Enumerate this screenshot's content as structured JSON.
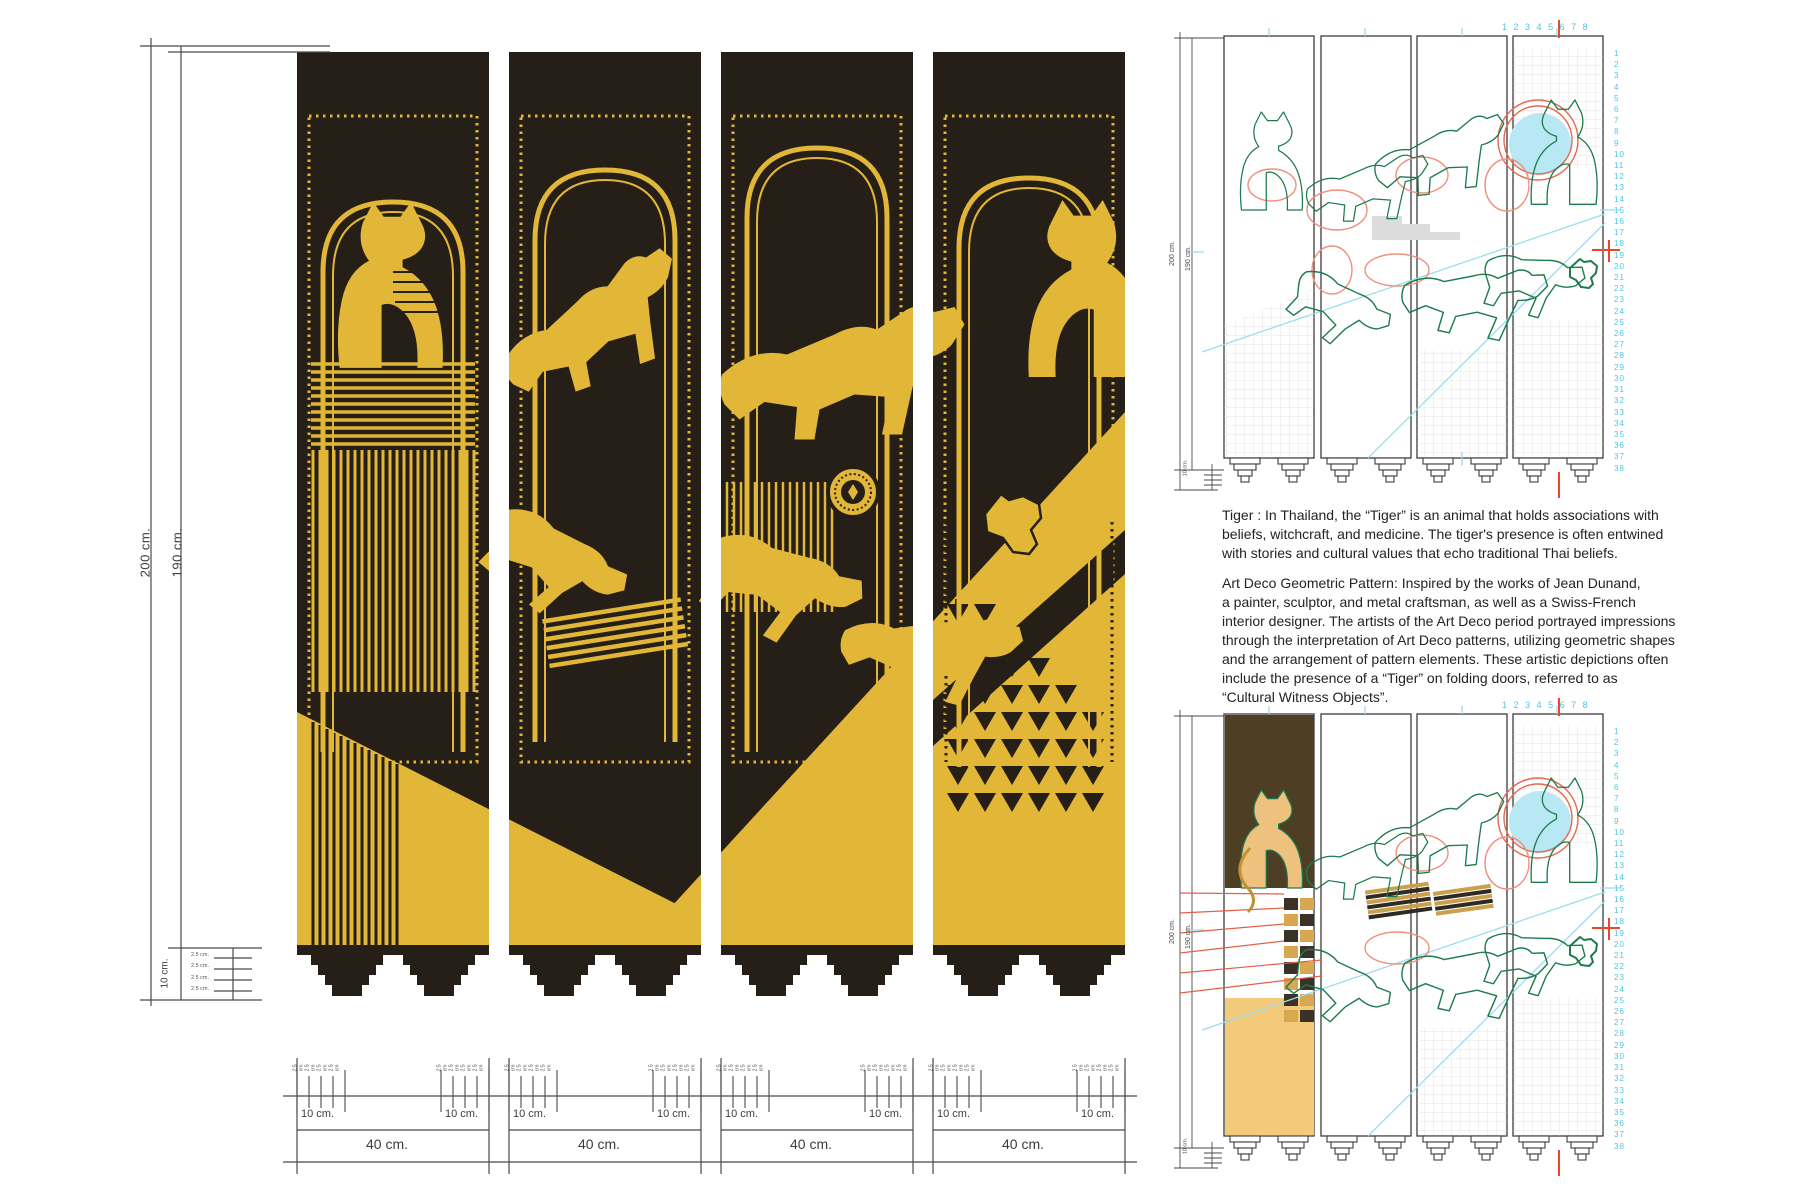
{
  "title": "Art Deco tiger folding screen — design sheet",
  "colors": {
    "gold": "#e2b637",
    "panel_black": "#251f17",
    "sketch_green": "#1d7b4e",
    "sketch_red": "#e26048",
    "sketch_red_light": "#f0907c",
    "sketch_blue": "#9bdcf0",
    "sketch_blue_fill": "#b9e8f5",
    "number_blue": "#4ec4e8",
    "brown_fill": "#4e3e24",
    "yellow_fill": "#f2ca7a",
    "tan_fill": "#eec27e",
    "dim_line": "#4a4a4a",
    "text": "#232323"
  },
  "left_dimensions": {
    "total_height_label": "200 cm.",
    "art_height_label": "190 cm.",
    "foot_height_label": "10 cm.",
    "foot_step_labels": [
      "2.5 cm.",
      "2.5 cm.",
      "2.5 cm.",
      "2.5 cm."
    ]
  },
  "bottom_dimensions": {
    "edge_label": "10 cm.",
    "panel_labels": [
      "40 cm.",
      "40 cm.",
      "40 cm.",
      "40 cm."
    ],
    "tick_labels": [
      "2.5 cm",
      "2.5 cm",
      "2.5 cm",
      "2.5 cm"
    ]
  },
  "description": {
    "paragraph1_lines": [
      "Tiger : In Thailand, the “Tiger” is an animal that holds associations with",
      "beliefs, witchcraft, and medicine. The tiger's presence is often entwined",
      "with stories and cultural values that echo traditional Thai beliefs."
    ],
    "paragraph2_lines": [
      "Art Deco Geometric Pattern: Inspired by the works of Jean Dunand,",
      "a painter, sculptor, and metal craftsman, as well as a Swiss-French",
      "interior designer. The artists of the Art Deco period portrayed impressions",
      "through the interpretation of Art Deco patterns, utilizing geometric shapes",
      "and the arrangement of pattern elements. These artistic depictions often",
      "include the presence of a “Tiger” on folding doors, referred to as",
      "“Cultural Witness Objects”."
    ]
  },
  "sketches": {
    "top_ruler_numbers": [
      "1",
      "2",
      "3",
      "4",
      "5",
      "6",
      "7",
      "8"
    ],
    "side_numbers": [
      "1",
      "2",
      "3",
      "4",
      "5",
      "6",
      "7",
      "8",
      "9",
      "10",
      "11",
      "12",
      "13",
      "14",
      "15",
      "16",
      "17",
      "18",
      "19",
      "20",
      "21",
      "22",
      "23",
      "24",
      "25",
      "26",
      "27",
      "28",
      "29",
      "30",
      "31",
      "32",
      "33",
      "34",
      "35",
      "36",
      "37",
      "38"
    ],
    "height_label": "200 cm.",
    "art_height_label": "190 cm.",
    "foot_label": "10 cm."
  }
}
